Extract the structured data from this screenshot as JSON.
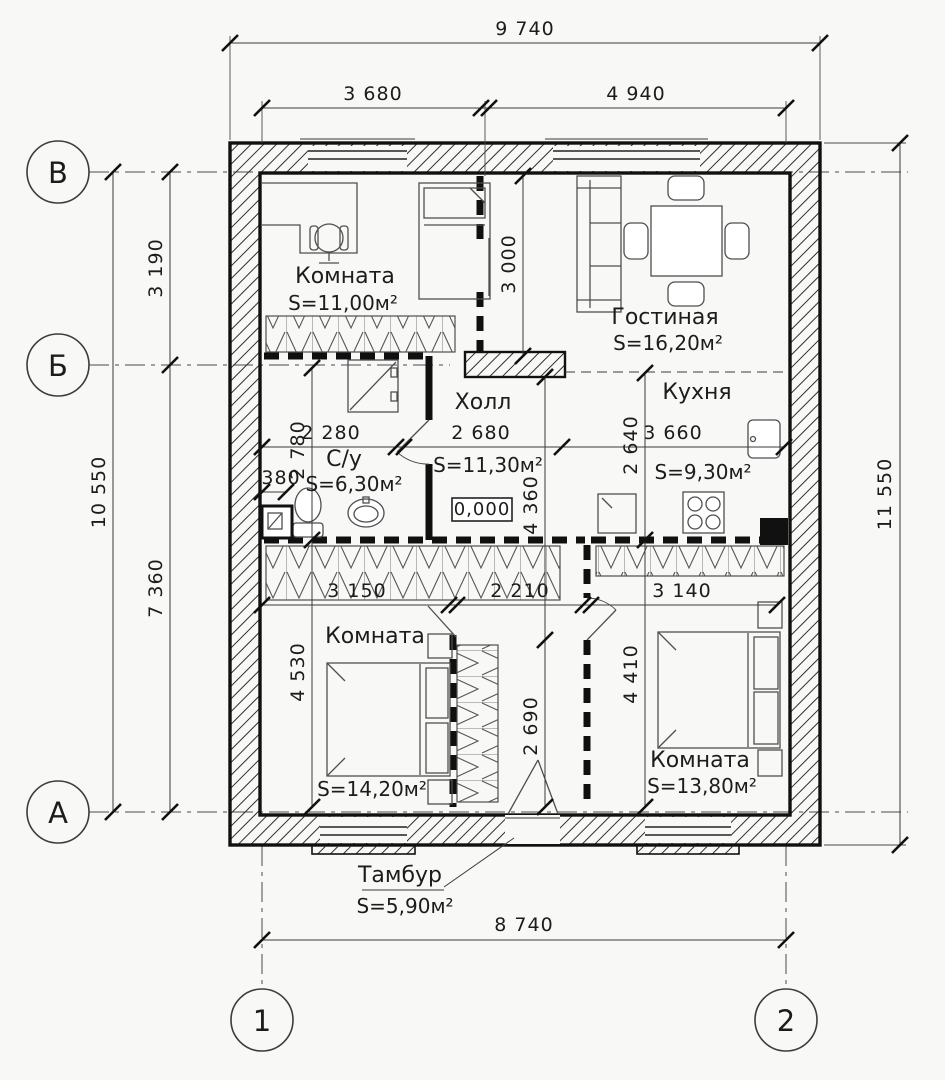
{
  "drawing": {
    "axes": {
      "rows": [
        "В",
        "Б",
        "А"
      ],
      "cols": [
        "1",
        "2"
      ]
    },
    "dims": {
      "overall_width": "9 740",
      "width_left": "3 680",
      "width_right": "4 940",
      "left_total": "10 550",
      "left_upper": "3 190",
      "left_lower": "7 360",
      "right_total": "11 550",
      "bottom_total": "8 740",
      "room1_depth": "3 000",
      "bath_depth": "2 780",
      "bath_width": "2 280",
      "hall_width": "2 680",
      "kitchen_width": "3 660",
      "kitchen_depth": "2 640",
      "niche": "380",
      "hall_depth": "4 360",
      "bed1_width": "3 150",
      "tambour_width": "2 210",
      "bed2_width": "3 140",
      "bed1_depth": "4 530",
      "tambour_depth": "2 690",
      "bed2_depth": "4 410"
    },
    "elevation": "0,000",
    "rooms": [
      {
        "name": "Комната",
        "area": "S=11,00м²"
      },
      {
        "name": "Гостиная",
        "area": "S=16,20м²"
      },
      {
        "name": "Кухня",
        "area": "S=9,30м²"
      },
      {
        "name": "Холл",
        "area": "S=11,30м²"
      },
      {
        "name": "С/у",
        "area": "S=6,30м²"
      },
      {
        "name": "Комната",
        "area": "S=14,20м²"
      },
      {
        "name": "Комната",
        "area": "S=13,80м²"
      },
      {
        "name": "Тамбур",
        "area": "S=5,90м²"
      }
    ]
  }
}
